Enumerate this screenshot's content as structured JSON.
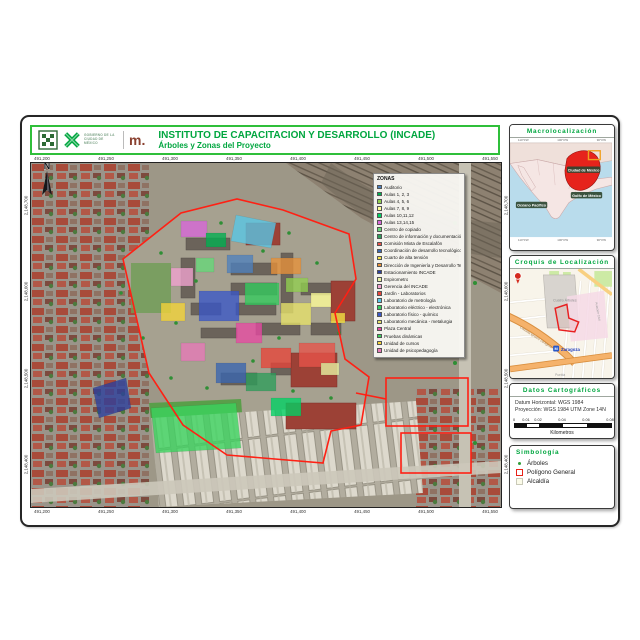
{
  "header": {
    "title": "INSTITUTO DE CAPACITACIÓN Y DESARROLLO (INCADE)",
    "subtitle": "Árboles y Zonas del Proyecto",
    "gov_logo_text": "GOBIERNO DE LA CIUDAD DE MÉXICO",
    "metro_logo_text": "m.",
    "accent_green": "#00a63f",
    "border_green": "#2fbf3a"
  },
  "map": {
    "north_label": "N",
    "boundary_color": "#ff2014",
    "x_labels_top": [
      "491,200",
      "491,250",
      "491,300",
      "491,350",
      "491,400",
      "491,450",
      "491,500",
      "491,550"
    ],
    "x_labels_bottom": [
      "491,200",
      "491,250",
      "491,300",
      "491,350",
      "491,400",
      "491,450",
      "491,500",
      "491,550"
    ],
    "y_labels_left": [
      "2,148,700",
      "2,148,600",
      "2,148,500",
      "2,148,400"
    ],
    "y_labels_right": [
      "2,148,700",
      "2,148,600",
      "2,148,500",
      "2,148,400"
    ],
    "legend": {
      "title": "ZONAS",
      "items": [
        {
          "label": "Auditorio",
          "color": "#4f81bd"
        },
        {
          "label": "Aulas 1, 2, 3",
          "color": "#00b050"
        },
        {
          "label": "Aulas 4, 5, 6",
          "color": "#92d050"
        },
        {
          "label": "Aulas 7, 8, 9",
          "color": "#ffff99"
        },
        {
          "label": "Aulas 10,11,12",
          "color": "#00d264"
        },
        {
          "label": "Aulas 13,14,15",
          "color": "#d967d9"
        },
        {
          "label": "Centro de copiado",
          "color": "#66d97a"
        },
        {
          "label": "Centro de información y documentación técnica",
          "color": "#2e9e5b"
        },
        {
          "label": "Comisión Mixta de Escalafón",
          "color": "#e8534a"
        },
        {
          "label": "Coordinación de desarrollo tecnológico",
          "color": "#3a66b0"
        },
        {
          "label": "Cuarto de alta tensión",
          "color": "#f5e342"
        },
        {
          "label": "Dirección de Ingeniería y Desarrollo Tecnológico",
          "color": "#e8923a"
        },
        {
          "label": "Estacionamiento INCADE",
          "color": "#2b3f9e"
        },
        {
          "label": "Espirometro",
          "color": "#e9f5a3"
        },
        {
          "label": "Gerencia del INCADE",
          "color": "#f2a3d0"
        },
        {
          "label": "Jardín - Laboratorios",
          "color": "#e8453a"
        },
        {
          "label": "Laboratorio de metrología",
          "color": "#57c8e8"
        },
        {
          "label": "Laboratorio eléctrico - electrónica",
          "color": "#33cc5e"
        },
        {
          "label": "Laboratorio físico - químico",
          "color": "#3a57c8"
        },
        {
          "label": "Laboratorio mecánica - metalurgia",
          "color": "#e8e36b"
        },
        {
          "label": "Plaza Central",
          "color": "#e84aa3"
        },
        {
          "label": "Pruebas dinámicas",
          "color": "#3ad45e"
        },
        {
          "label": "Unidad de cursos",
          "color": "#f5d53a"
        },
        {
          "label": "Unidad de psicopedagogía",
          "color": "#e87ab8"
        }
      ]
    }
  },
  "panels": {
    "macro": {
      "title": "Macrolocalización",
      "label_cdmx": "Ciudad de México",
      "label_golfo": "Golfo de México",
      "label_pacifico": "Océano Pacífico",
      "coords_top": [
        "110°0'W",
        "100°0'W",
        "90°0'W"
      ],
      "coords_bottom": [
        "110°0'W",
        "100°0'W",
        "90°0'W"
      ]
    },
    "croquis": {
      "title": "Croquis de Localización",
      "label_colonia": "Cuatro Árboles",
      "label_metro": "Zaragoza",
      "metro_icon": "M",
      "label_road": "Calzada Ignacio Zaragoza",
      "label_street1": "Aviación Civil",
      "label_street2": "Puebla"
    },
    "datos": {
      "title": "Datos Cartográficos",
      "line1": "Datum Horizontal: WGS 1984",
      "line2": "Proyección: WGS 1984 UTM Zone 14N",
      "scale_ticks": [
        {
          "t": "0",
          "pos": 0
        },
        {
          "t": "0.01",
          "pos": 12
        },
        {
          "t": "0.02",
          "pos": 24
        },
        {
          "t": "0.04",
          "pos": 48
        },
        {
          "t": "0.06",
          "pos": 72
        },
        {
          "t": "0.08",
          "pos": 96
        }
      ],
      "scale_unit": "Kilometros"
    },
    "simbologia": {
      "title": "Simbología",
      "item_arboles": "Árboles",
      "item_poligono": "Polígono General",
      "item_alcaldia": "Alcaldía"
    }
  }
}
